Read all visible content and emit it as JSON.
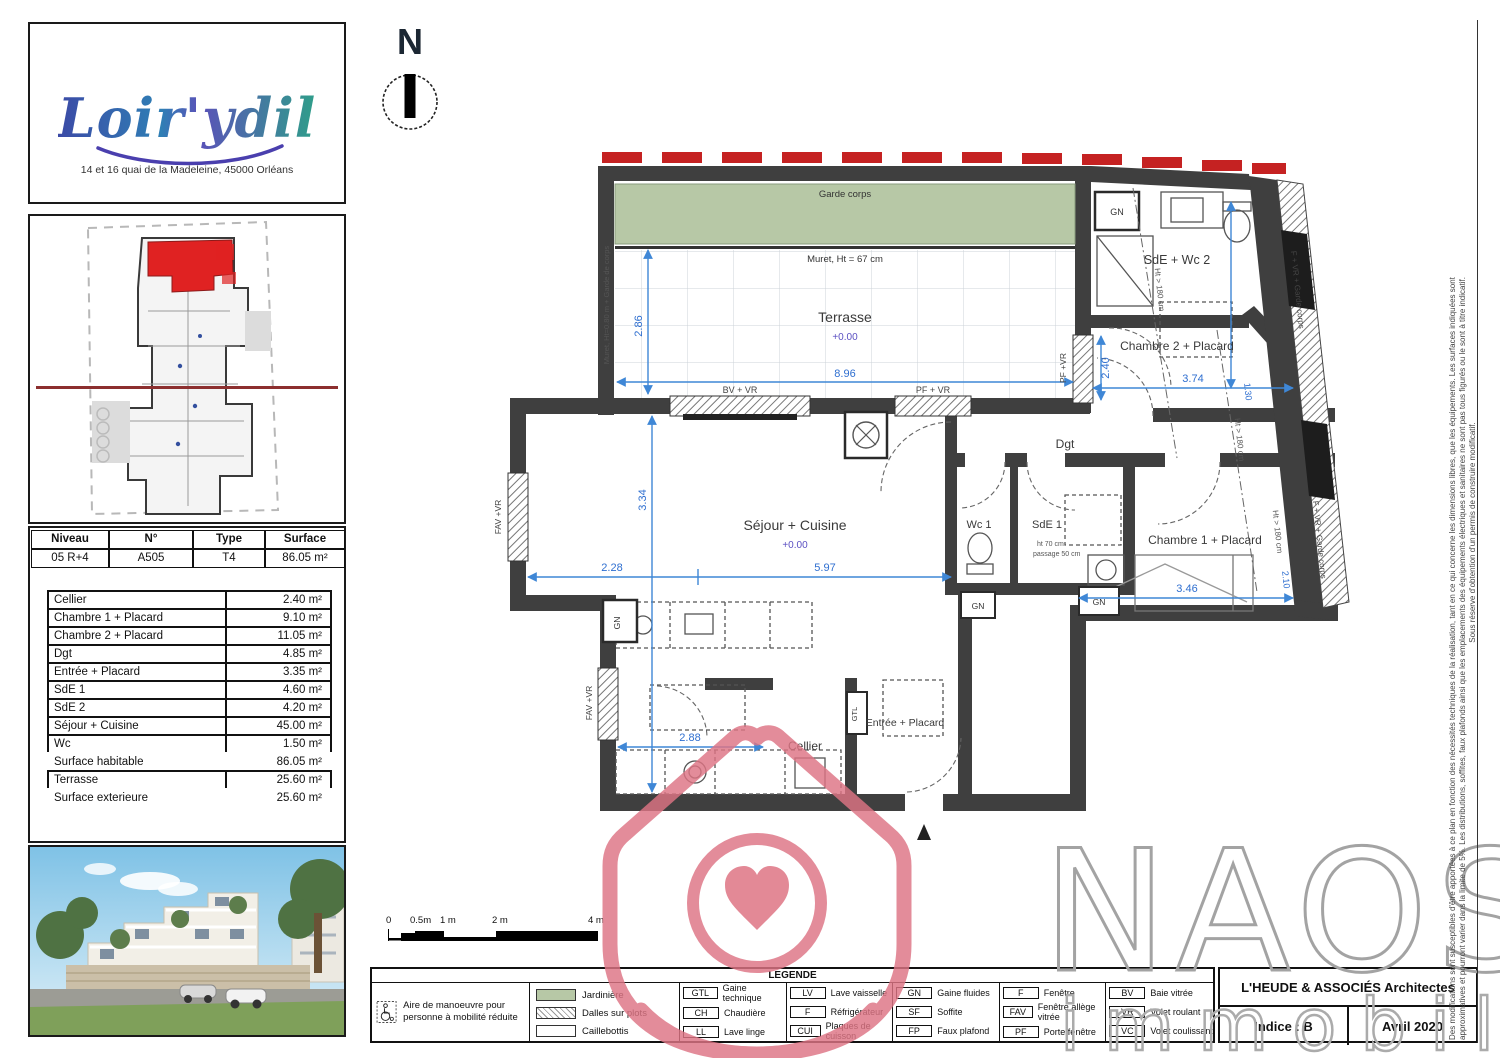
{
  "branding": {
    "logo": "Loir'ydil",
    "address": "14 et 16 quai de la Madeleine, 45000 Orléans"
  },
  "unit_table": {
    "headers": [
      "Niveau",
      "N°",
      "Type",
      "Surface"
    ],
    "values": [
      "05 R+4",
      "A505",
      "T4",
      "86.05 m²"
    ]
  },
  "rooms_table": {
    "rows": [
      {
        "label": "Cellier",
        "value": "2.40 m²"
      },
      {
        "label": "Chambre 1 + Placard",
        "value": "9.10 m²"
      },
      {
        "label": "Chambre 2 + Placard",
        "value": "11.05 m²"
      },
      {
        "label": "Dgt",
        "value": "4.85 m²"
      },
      {
        "label": "Entrée + Placard",
        "value": "3.35 m²"
      },
      {
        "label": "SdE 1",
        "value": "4.60 m²"
      },
      {
        "label": "SdE 2",
        "value": "4.20 m²"
      },
      {
        "label": "Séjour + Cuisine",
        "value": "45.00 m²"
      },
      {
        "label": "Wc",
        "value": "1.50 m²"
      },
      {
        "label": "Surface habitable",
        "value": "86.05 m²"
      },
      {
        "label": "Terrasse",
        "value": "25.60 m²"
      },
      {
        "label": "Surface exterieure",
        "value": "25.60 m²"
      }
    ]
  },
  "north_label": "N",
  "plan": {
    "rooms": {
      "terrasse": "Terrasse",
      "terrasse_level": "+0.00",
      "sejour": "Séjour + Cuisine",
      "sejour_level": "+0.00",
      "cellier": "Cellier",
      "entree": "Entrée + Placard",
      "wc1": "Wc 1",
      "sde1": "SdE 1",
      "dgt": "Dgt",
      "sdewc2": "SdE + Wc 2",
      "chambre2": "Chambre 2 + Placard",
      "chambre1": "Chambre 1 + Placard"
    },
    "annotations": {
      "garde_corps": "Garde corps",
      "muret": "Muret, Ht = 67 cm",
      "muret_left": "Muret, Ht=0.80 m + Garde de corps",
      "passage": "passage 50 cm",
      "ht70": "ht 70 cm"
    },
    "wall_labels": {
      "bv_vr": "BV + VR",
      "pf_vr": "PF + VR",
      "pf_vr_right": "PF +VR",
      "fav_vr": "FAV +VR",
      "f_vr_garde": "F + VR + Garde corps",
      "gn": "GN",
      "gtl": "GTL"
    },
    "heights": {
      "h180": "Ht > 180 cm",
      "v130": "1.30",
      "v210": "2.10"
    },
    "dims": {
      "terrace_w": "8.96",
      "terrace_h": "2.86",
      "sejour_a": "2.28",
      "sejour_b": "5.97",
      "sejour_h": "3.34",
      "kitchen": "2.88",
      "chambre2": "3.74",
      "chambre1": "3.46",
      "right": "2.40"
    }
  },
  "scalebar": {
    "labels": [
      "0",
      "0.5m",
      "1 m",
      "2 m",
      "4 m"
    ]
  },
  "legend": {
    "title": "LEGENDE",
    "pmr": "Aire de manoeuvre pour personne à mobilité réduite",
    "swatches": [
      {
        "label": "Jardinière"
      },
      {
        "label": "Dalles sur plots"
      },
      {
        "label": "Caillebottis"
      }
    ],
    "codes": [
      {
        "code": "GTL",
        "label": "Gaine technique"
      },
      {
        "code": "CH",
        "label": "Chaudière"
      },
      {
        "code": "LL",
        "label": "Lave linge"
      },
      {
        "code": "LV",
        "label": "Lave vaisselle"
      },
      {
        "code": "F",
        "label": "Réfrigérateur"
      },
      {
        "code": "CUI",
        "label": "Plaques de cuisson"
      },
      {
        "code": "GN",
        "label": "Gaine fluides"
      },
      {
        "code": "SF",
        "label": "Soffite"
      },
      {
        "code": "FP",
        "label": "Faux plafond"
      },
      {
        "code": "F",
        "label": "Fenêtre"
      },
      {
        "code": "FAV",
        "label": "Fenêtre allège vitrée"
      },
      {
        "code": "PF",
        "label": "Porte fenêtre"
      },
      {
        "code": "BV",
        "label": "Baie vitrée"
      },
      {
        "code": "VR",
        "label": "Volet roulant"
      },
      {
        "code": "VC",
        "label": "Volet coulissant"
      }
    ]
  },
  "titleblock": {
    "architect": "L'HEUDE & ASSOCIÉS Architectes",
    "indice": "Indice : B",
    "date": "Avril 2020"
  },
  "watermark": {
    "name": "NAOS",
    "sub": "immobilier"
  },
  "disclaimer": {
    "line1": "Des modifications sont susceptibles d'être apportées à ce plan en fonction des nécessités techniques de la réalisation, tant en ce qui concerne les dimensions libres, que les équipements. Les surfaces indiquées sont",
    "line2": "approximatives et pourront varier dans la limite de 5%. Les distributions, soffites, faux plafonds ainsi que les emplacements des équipements électriques et sanitaires ne sont pas tous figurés ou le sont à titre indicatif.",
    "line3": "Sous réserve d'obtention d'un permis de construire modificatif."
  },
  "colors": {
    "wall": "#3f3f3f",
    "dim_blue": "#3f87d6",
    "level_violet": "#5b50c2",
    "jardiniere_green": "#b7c8a6",
    "accent_red": "#c52222",
    "watermark_pink": "#de7484",
    "naos_gray": "#a3a3a3",
    "logo_blue": "#3b4aa6",
    "logo_teal": "#2f9e8a"
  }
}
